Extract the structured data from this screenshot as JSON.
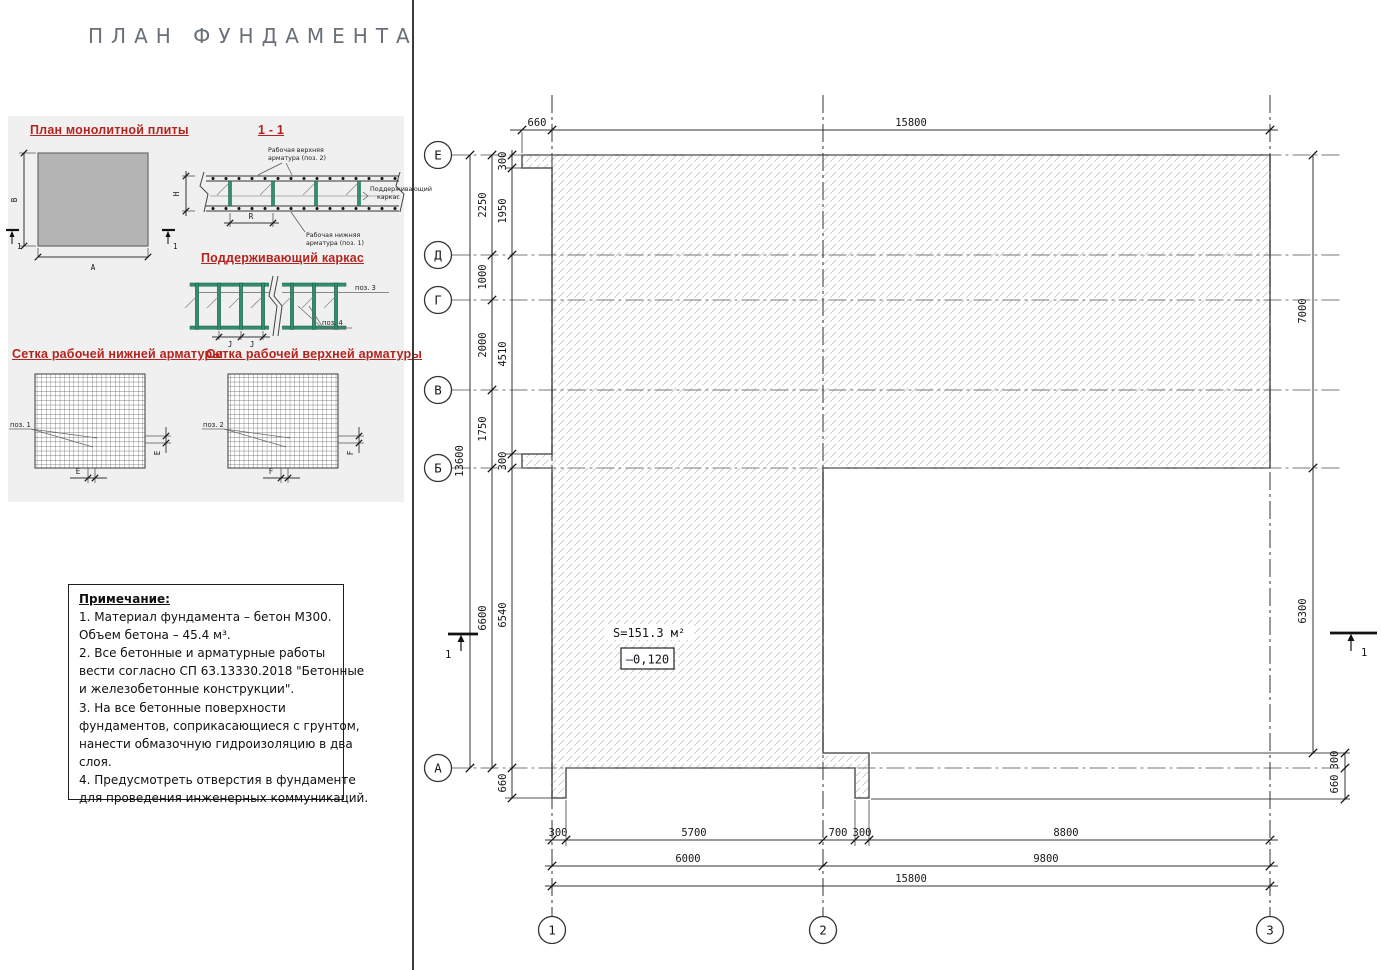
{
  "title": "ПЛАН ФУНДАМЕНТА",
  "panel": {
    "headings": {
      "plan_slab": "План монолитной плиты",
      "section": "1 - 1",
      "frame": "Поддерживающий каркас",
      "mesh_lower": "Сетка рабочей нижней арматуры",
      "mesh_upper": "Сетка рабочей верхней арматуры"
    },
    "slab_plan": {
      "dim_width": "A",
      "dim_height": "B",
      "section_mark": "1"
    },
    "section": {
      "top_rebar_1": "Рабочая верхняя",
      "top_rebar_2": "арматура (поз. 2)",
      "frame_1": "Поддерживающий",
      "frame_2": "каркас",
      "bottom_rebar_1": "Рабочая нижняя",
      "bottom_rebar_2": "арматура (поз. 1)",
      "dim_height": "H",
      "dim_step": "R"
    },
    "frame": {
      "pos3": "поз. 3",
      "pos4": "поз. 4",
      "dim_j": "J"
    },
    "mesh_lower": {
      "pos": "поз. 1",
      "dim": "E"
    },
    "mesh_upper": {
      "pos": "поз. 2",
      "dim": "F"
    }
  },
  "notes": {
    "title": "Примечание:",
    "lines": [
      "1. Материал фундамента – бетон М300.",
      "Объем бетона –  45.4 м³.",
      "2. Все бетонные и арматурные работы",
      "вести согласно СП 63.13330.2018 \"Бетонные",
      "и железобетонные конструкции\".",
      "3. На все бетонные поверхности",
      "фундаментов, соприкасающиеся с грунтом,",
      "нанести обмазочную гидроизоляцию в два",
      "слоя.",
      "4. Предусмотреть отверстия в фундаменте",
      "для проведения инженерных коммуникаций."
    ]
  },
  "plan": {
    "axes_rows": [
      "Е",
      "Д",
      "Г",
      "В",
      "Б",
      "А"
    ],
    "axes_cols": [
      "1",
      "2",
      "3"
    ],
    "dims": {
      "top": [
        "660",
        "15800"
      ],
      "left_total": "13600",
      "left_pitch": [
        "2250",
        "1000",
        "2000",
        "1750",
        "6600"
      ],
      "left_inner": [
        "300",
        "1950",
        "4510",
        "300",
        "6540"
      ],
      "left_tab": "660",
      "bottom_r1": [
        "300",
        "5700",
        "700",
        "300",
        "8800"
      ],
      "bottom_r2": [
        "6000",
        "9800"
      ],
      "bottom_r3": "15800",
      "right_main": [
        "7000",
        "6300"
      ],
      "right_tab": [
        "300",
        "660"
      ]
    },
    "area_label": "S=151.3 м²",
    "elevation": "–0,120",
    "section_mark": "1"
  },
  "colors": {
    "heading_red": "#b3241f",
    "rebar_green": "#2f8f72",
    "hatch": "#c6c6c6"
  }
}
